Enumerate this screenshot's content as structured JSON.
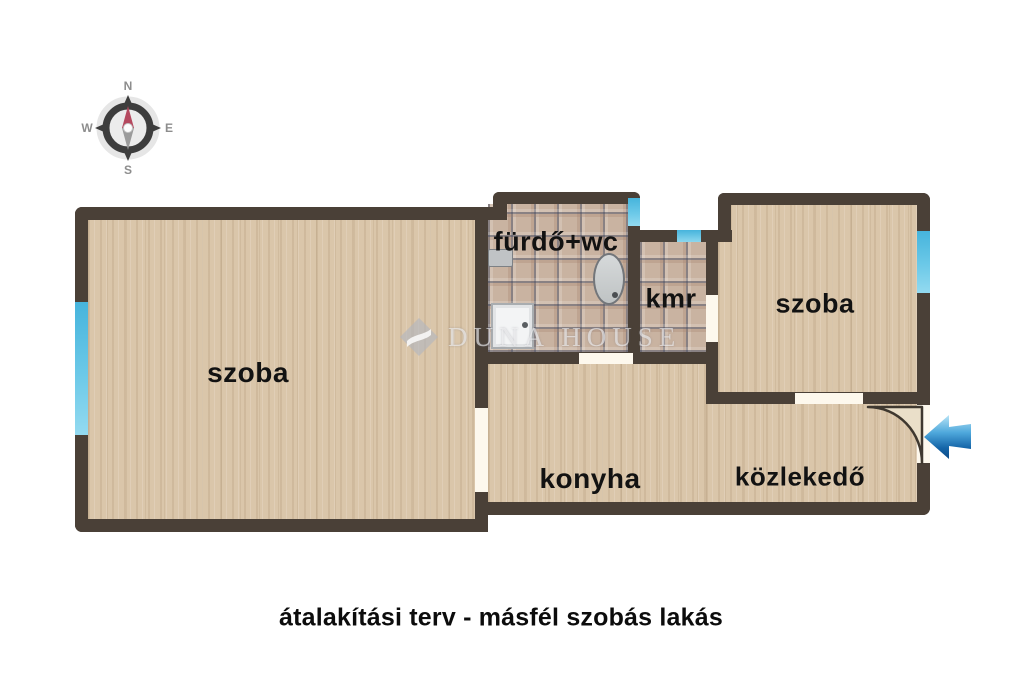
{
  "caption": {
    "text": "átalakítási terv - másfél szobás lakás"
  },
  "compass": {
    "icon": "compass-rose-icon",
    "n": "N",
    "e": "E",
    "s": "S",
    "w": "W"
  },
  "watermark": {
    "logo_icon": "duna-house-diamond-logo-icon",
    "text": "DUNA HOUSE"
  },
  "rooms": [
    {
      "name": "szoba-left",
      "label": "szoba"
    },
    {
      "name": "furdo-wc",
      "label": "fürdő+wc"
    },
    {
      "name": "kmr",
      "label": "kmr"
    },
    {
      "name": "szoba-right",
      "label": "szoba"
    },
    {
      "name": "konyha",
      "label": "konyha"
    },
    {
      "name": "kozlekedo",
      "label": "közlekedő"
    }
  ],
  "entrance": {
    "arrow_icon": "entrance-arrow-icon",
    "door_swing_icon": "door-swing-arc-icon",
    "direction": "left"
  },
  "fixtures": [
    {
      "name": "washbasin"
    },
    {
      "name": "bathtub"
    },
    {
      "name": "shower-tray"
    }
  ],
  "colors": {
    "wall": "#4a4037",
    "wood_floor": "#dac6aa",
    "tile_floor": "#c9b3a1",
    "window": "#5bc0e2",
    "door_opening": "#fdf8ed",
    "arrow_blue_dark": "#0d4a86",
    "arrow_blue_light": "#b8e4f6"
  }
}
